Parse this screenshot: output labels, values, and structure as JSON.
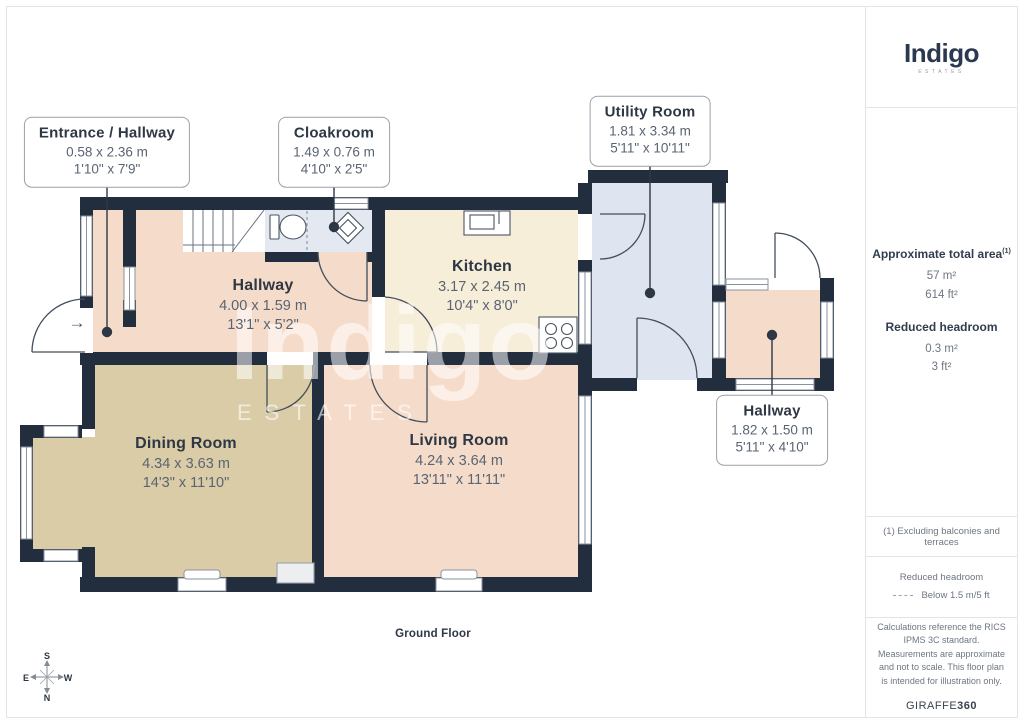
{
  "branding": {
    "logo": "Indigo",
    "logo_sub": "ESTATES"
  },
  "watermark": {
    "text": "Indigo",
    "sub": "ESTATES"
  },
  "plan": {
    "floor_label": "Ground Floor",
    "entrance_arrow": "→"
  },
  "compass": {
    "n": "N",
    "s": "S",
    "e": "E",
    "w": "W"
  },
  "rooms": [
    {
      "name": "Entrance / Hallway",
      "metric": "0.58 x 2.36 m",
      "imperial": "1'10\" x 7'9\""
    },
    {
      "name": "Cloakroom",
      "metric": "1.49 x 0.76 m",
      "imperial": "4'10\" x 2'5\""
    },
    {
      "name": "Utility Room",
      "metric": "1.81 x 3.34 m",
      "imperial": "5'11\" x 10'11\""
    },
    {
      "name": "Hallway",
      "metric": "4.00 x 1.59 m",
      "imperial": "13'1\" x 5'2\""
    },
    {
      "name": "Kitchen",
      "metric": "3.17 x 2.45 m",
      "imperial": "10'4\" x 8'0\""
    },
    {
      "name": "Dining Room",
      "metric": "4.34 x 3.63 m",
      "imperial": "14'3\" x 11'10\""
    },
    {
      "name": "Living Room",
      "metric": "4.24 x 3.64 m",
      "imperial": "13'11\" x 11'11\""
    },
    {
      "name": "Hallway",
      "metric": "1.82 x 1.50 m",
      "imperial": "5'11\" x 4'10\""
    }
  ],
  "sidebar": {
    "total_area_label": "Approximate total area",
    "total_area_ref": "(1)",
    "total_area_m": "57 m²",
    "total_area_ft": "614 ft²",
    "reduced_label": "Reduced headroom",
    "reduced_m": "0.3 m²",
    "reduced_ft": "3 ft²",
    "note": "(1) Excluding balconies and terraces",
    "legend_title": "Reduced headroom",
    "legend_value": "Below 1.5 m/5 ft",
    "disclaimer": "Calculations reference the RICS IPMS 3C standard. Measurements are approximate and not to scale. This floor plan is intended for illustration only.",
    "brand_footer_a": "GIRAFFE",
    "brand_footer_b": "360"
  },
  "colors": {
    "wall": "#222e3e",
    "hallway_floor": "#f5dcca",
    "kitchen_floor": "#f7eeda",
    "dining_floor": "#d9cca7",
    "utility_floor": "#dee4f0",
    "cloakroom_floor": "#e4e8f1",
    "watermark": "rgba(255,255,255,0.55)"
  }
}
